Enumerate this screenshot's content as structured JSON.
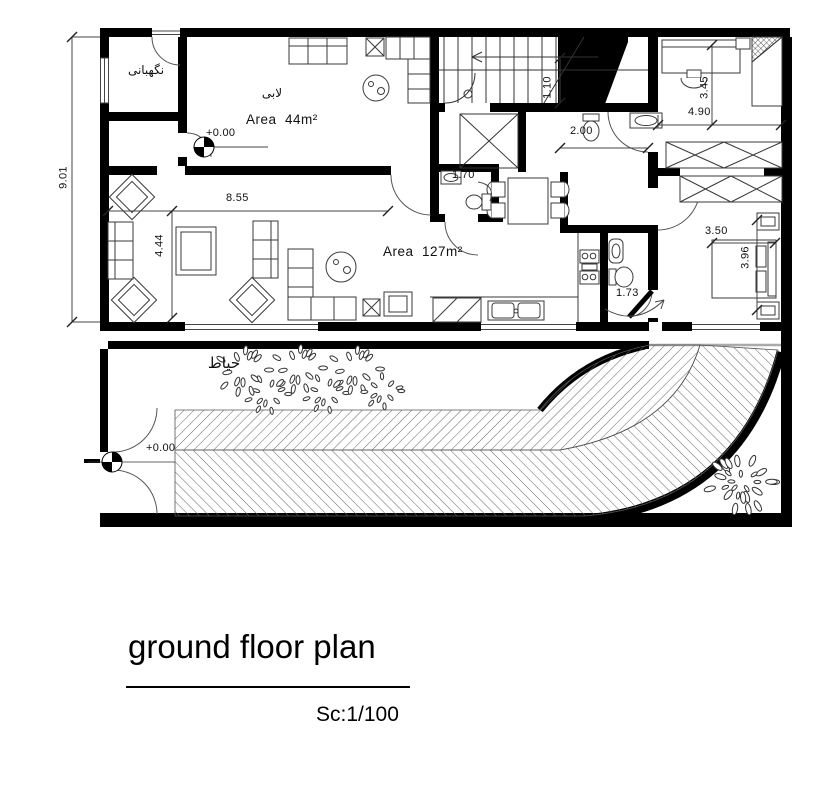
{
  "plan": {
    "rooms": {
      "guard_room": "نگهبانی",
      "lobby": "لابی",
      "lobby_area": "Area  44m²",
      "living_area": "Area  127m²",
      "courtyard": "حیاط"
    },
    "levels": {
      "lobby_level": "+0.00",
      "gate_level": "+0.00"
    },
    "dimensions": {
      "site_height": "9.01",
      "living_width": "8.55",
      "living_depth": "4.44",
      "wc_width": "1.70",
      "stair_width": "1.10",
      "corridor_width": "2.00",
      "bedroom1_depth": "3.45",
      "bedroom1_width": "4.90",
      "bedroom2_width": "3.50",
      "bedroom2_depth": "3.96",
      "bathroom_width": "1.73"
    }
  },
  "title_block": {
    "title": "ground floor plan",
    "scale_label": "Sc:1/100"
  },
  "colors": {
    "ink": "#000000",
    "hatch_line": "#555555",
    "paper": "#ffffff"
  }
}
